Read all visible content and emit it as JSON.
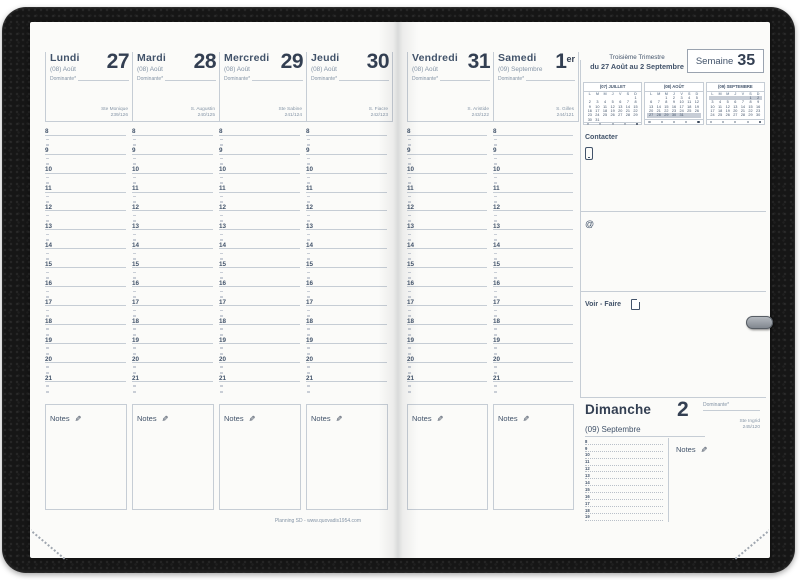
{
  "planner": {
    "trimester": "Troisième Trimestre",
    "week_range": "du 27 Août au 2 Septembre",
    "week_label": "Semaine",
    "week_number": "35",
    "footer": "Planning SD - www.quovadis1954.com"
  },
  "labels": {
    "notes": "Notes",
    "contact": "Contacter",
    "todo": "Voir - Faire",
    "at_symbol": "@"
  },
  "icons": {
    "pencil": "✎",
    "phone": "phone-outline",
    "page": "page-outline"
  },
  "hours": [
    "8",
    "9",
    "10",
    "11",
    "12",
    "13",
    "14",
    "15",
    "16",
    "17",
    "18",
    "19",
    "20",
    "21"
  ],
  "days": [
    {
      "name": "Lundi",
      "month": "(08) Août",
      "num": "27",
      "suffix": "",
      "dominante": "Dominante*",
      "saint": "Ste Monique",
      "day_count": "239/126"
    },
    {
      "name": "Mardi",
      "month": "(08) Août",
      "num": "28",
      "suffix": "",
      "dominante": "Dominante*",
      "saint": "S. Augustin",
      "day_count": "240/125"
    },
    {
      "name": "Mercredi",
      "month": "(08) Août",
      "num": "29",
      "suffix": "",
      "dominante": "Dominante*",
      "saint": "Ste Sabine",
      "day_count": "241/124"
    },
    {
      "name": "Jeudi",
      "month": "(08) Août",
      "num": "30",
      "suffix": "",
      "dominante": "Dominante*",
      "saint": "S. Fiacre",
      "day_count": "242/123"
    },
    {
      "name": "Vendredi",
      "month": "(08) Août",
      "num": "31",
      "suffix": "",
      "dominante": "Dominante*",
      "saint": "S. Aristide",
      "day_count": "243/122"
    },
    {
      "name": "Samedi",
      "month": "(09) Septembre",
      "num": "1",
      "suffix": "er",
      "dominante": "Dominante*",
      "saint": "S. Gilles",
      "day_count": "244/121"
    }
  ],
  "sunday": {
    "name": "Dimanche",
    "num": "2",
    "month": "(09) Septembre",
    "dominante": "Dominante*",
    "saint": "Ste Ingrid",
    "day_count": "245/120",
    "hours": [
      "8",
      "9",
      "10",
      "11",
      "12",
      "13",
      "14",
      "15",
      "16",
      "17",
      "18",
      "19"
    ]
  },
  "mini_calendars": [
    {
      "title": "(07) JUILLET",
      "dows": [
        "L",
        "M",
        "M",
        "J",
        "V",
        "S",
        "D"
      ],
      "rows": [
        [
          "",
          "",
          "",
          "",
          "",
          "",
          "1"
        ],
        [
          "2",
          "3",
          "4",
          "5",
          "6",
          "7",
          "8"
        ],
        [
          "9",
          "10",
          "11",
          "12",
          "13",
          "14",
          "15"
        ],
        [
          "16",
          "17",
          "18",
          "19",
          "20",
          "21",
          "22"
        ],
        [
          "23",
          "24",
          "25",
          "26",
          "27",
          "28",
          "29"
        ],
        [
          "30",
          "31",
          "",
          "",
          "",
          "",
          ""
        ]
      ],
      "highlight_row": -1
    },
    {
      "title": "(08) AOÛT",
      "dows": [
        "L",
        "M",
        "M",
        "J",
        "V",
        "S",
        "D"
      ],
      "rows": [
        [
          "",
          "",
          "1",
          "2",
          "3",
          "4",
          "5"
        ],
        [
          "6",
          "7",
          "8",
          "9",
          "10",
          "11",
          "12"
        ],
        [
          "13",
          "14",
          "15",
          "16",
          "17",
          "18",
          "19"
        ],
        [
          "20",
          "21",
          "22",
          "23",
          "24",
          "25",
          "26"
        ],
        [
          "27",
          "28",
          "29",
          "30",
          "31",
          "",
          ""
        ]
      ],
      "highlight_row": 4
    },
    {
      "title": "(09) SEPTEMBRE",
      "dows": [
        "L",
        "M",
        "M",
        "J",
        "V",
        "S",
        "D"
      ],
      "rows": [
        [
          "",
          "",
          "",
          "",
          "",
          "1",
          "2"
        ],
        [
          "3",
          "4",
          "5",
          "6",
          "7",
          "8",
          "9"
        ],
        [
          "10",
          "11",
          "12",
          "13",
          "14",
          "15",
          "16"
        ],
        [
          "17",
          "18",
          "19",
          "20",
          "21",
          "22",
          "23"
        ],
        [
          "24",
          "25",
          "26",
          "27",
          "28",
          "29",
          "30"
        ]
      ],
      "highlight_row": 0
    }
  ],
  "colors": {
    "ink": "#42536a",
    "ink_dark": "#333f52",
    "ink_light": "#8494a6",
    "line": "#c6cdd5",
    "highlight": "#c7cdd6",
    "page": "#fbfbf9",
    "cover": "#161616"
  }
}
